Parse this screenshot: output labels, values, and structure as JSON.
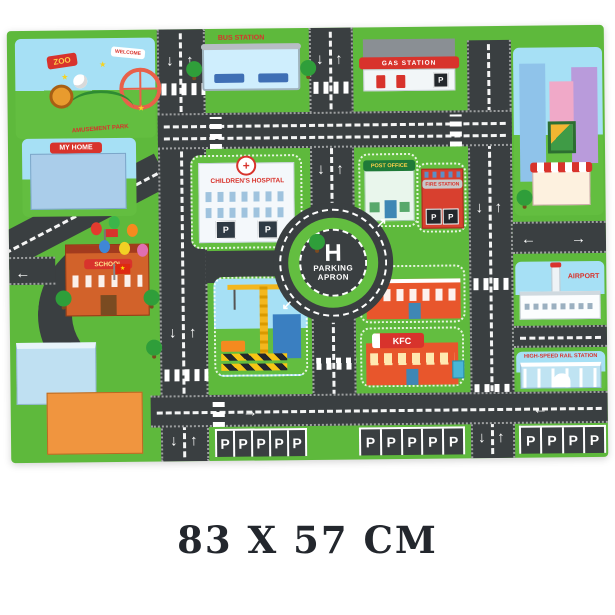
{
  "product": {
    "size_caption": "83 X 57 CM"
  },
  "mat": {
    "labels": {
      "zoo": "ZOO",
      "amusement_park": "AMUSEMENT PARK",
      "welcome": "WELCOME",
      "bus_station": "BUS STATION",
      "gas_station": "GAS STATION",
      "my_home": "MY HOME",
      "childrens_hospital": "CHILDREN'S HOSPITAL",
      "post_office": "POST OFFICE",
      "fire_station": "FIRE STATION",
      "school": "SCHOOL",
      "helipad_letter": "H",
      "parking_apron_line1": "PARKING",
      "parking_apron_line2": "APRON",
      "mcdonalds_arches": "M",
      "kfc": "KFC",
      "airport": "AIRPORT",
      "rail_station": "HIGH-SPEED RAIL STATION",
      "parking_letter": "P"
    },
    "parking_rows": [
      {
        "count": 5
      },
      {
        "count": 5
      },
      {
        "count": 4
      }
    ],
    "icons": {
      "up_arrow": "↑",
      "down_arrow": "↓",
      "left_arrow": "←",
      "right_arrow": "→",
      "turn_arrow_ne": "↗",
      "turn_arrow_sw": "↙",
      "star": "★",
      "cross": "+"
    },
    "colors": {
      "road": "#3a3f41",
      "grass": "#5eb93c",
      "grass2": "#63be40",
      "sky": "#a6e0f5",
      "sign_red": "#d8332c",
      "marking": "#ffffff"
    }
  }
}
